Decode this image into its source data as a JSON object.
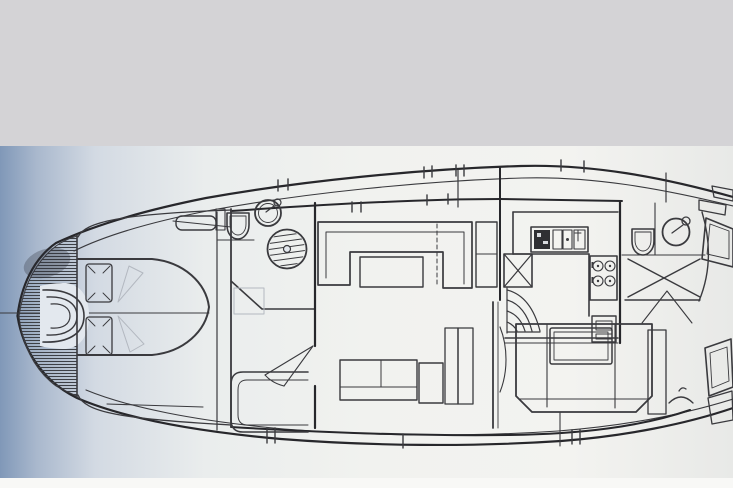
{
  "figure": {
    "kind": "yacht-deck-plan",
    "view": "top-down interior layout drawing, bow at left, stern cropped at right edge"
  },
  "colors": {
    "top_band": "#d4d3d6",
    "paper_highlight": "#f1f2ef",
    "paper_shadow_left": "#8098b8",
    "paper_right": "#e8e9e7",
    "bottom_strip": "#f8f8f6",
    "ink": "#3a3a3e",
    "ink_heavy": "#27272b",
    "faint": "#b3b8c0",
    "hatch": "#3d4046",
    "dark_fill": "#2f2f33",
    "inset": "#e3e8ee"
  },
  "regions": {
    "foredeck": "hatched foredeck with anchor-locker chevrons",
    "v_berth": "island berth with two pillows",
    "forward_head": "head with toilet, round basin and circular shower pan",
    "saloon": "U-shaped settee with table and sideboard",
    "galley": "L-galley with icebox, twin sink, four-burner stove and oven",
    "companionway": "curved steps",
    "aft_head": "head with toilet, round basin and cross-marked shower floor",
    "aft_cabin": "double berth with side panels and hanging locker",
    "port_side": "settee, sideboard cabinet and tall lockers",
    "stern": "angled side windows and deck boxes"
  },
  "icons": [
    "toilet-icon",
    "washbasin-icon",
    "shower-pan-icon",
    "shower-floor-icon",
    "stove-burner-icon",
    "sink-icon",
    "icebox-icon",
    "steps-icon",
    "clothes-hanger-icon",
    "pillow-icon",
    "door-swing-icon",
    "window-icon",
    "deck-hatch-icon",
    "anchor-locker-icon",
    "centerline",
    "tick-mark"
  ]
}
